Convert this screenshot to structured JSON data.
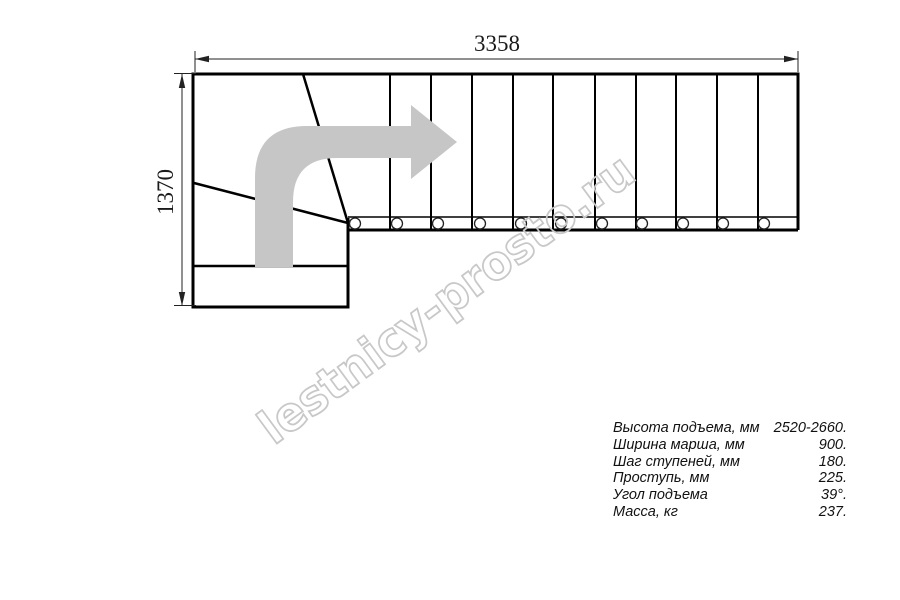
{
  "drawing_title": "L-shaped staircase plan",
  "dims": {
    "width": "3358",
    "height": "1370"
  },
  "watermark": {
    "text": "lestnicy-prosto.ru",
    "color": "#c8c8c8"
  },
  "arrow": {
    "color": "#c6c6c6"
  },
  "line_color": "#000000",
  "specs": {
    "rows": [
      {
        "label": "Высота подъема, мм",
        "value": "2520-2660."
      },
      {
        "label": "Ширина марша, мм",
        "value": "900."
      },
      {
        "label": "Шаг ступеней, мм",
        "value": "180."
      },
      {
        "label": "Проступь, мм",
        "value": "225."
      },
      {
        "label": "Угол подъема",
        "value": "39°."
      },
      {
        "label": "Масса, кг",
        "value": "237."
      }
    ]
  }
}
